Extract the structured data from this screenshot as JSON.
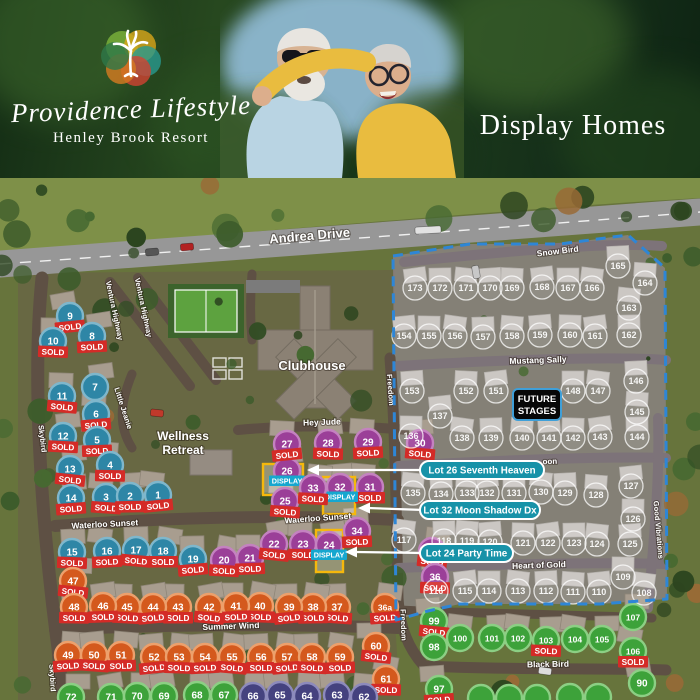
{
  "header": {
    "brand_script": "Providence Lifestyle",
    "brand_sub": "Henley Brook Resort",
    "page_title": "Display Homes"
  },
  "status_labels": {
    "sold": "SOLD",
    "display": "DISPLAY"
  },
  "future_badge": {
    "line1": "FUTURE",
    "line2": "STAGES"
  },
  "callouts": [
    {
      "label": "Lot 26 Seventh Heaven",
      "px": 420,
      "py": 283,
      "pw": 124,
      "ph": 18,
      "ax": 307,
      "ay": 292
    },
    {
      "label": "Lot 32 Moon Shadow Dx",
      "px": 420,
      "py": 323,
      "pw": 120,
      "ph": 18,
      "ax": 358,
      "ay": 330
    },
    {
      "label": "Lot 24 Party Time",
      "px": 420,
      "py": 366,
      "pw": 93,
      "ph": 18,
      "ax": 345,
      "ay": 374
    }
  ],
  "place_labels": [
    {
      "lines": [
        "Wellness",
        "Retreat"
      ],
      "x": 183,
      "y": 262,
      "size": 12
    },
    {
      "lines": [
        "Clubhouse"
      ],
      "x": 312,
      "y": 192,
      "size": 13
    }
  ],
  "street_labels": [
    {
      "text": "Andrea Drive",
      "x": 310,
      "y": 62,
      "rot": -5,
      "size": 13
    },
    {
      "text": "Ventura Highway",
      "x": 112,
      "y": 133,
      "rot": 78,
      "size": 7.5
    },
    {
      "text": "Ventura Highway",
      "x": 141,
      "y": 130,
      "rot": 78,
      "size": 7.5
    },
    {
      "text": "Skybird",
      "x": 40,
      "y": 261,
      "rot": 83,
      "size": 7.5
    },
    {
      "text": "Skybird",
      "x": 50,
      "y": 500,
      "rot": 87,
      "size": 7.5
    },
    {
      "text": "Little Jeanie",
      "x": 121,
      "y": 231,
      "rot": 72,
      "size": 7.5
    },
    {
      "text": "Hey Jude",
      "x": 322,
      "y": 247,
      "rot": -2,
      "size": 8.5
    },
    {
      "text": "Waterloo Sunset",
      "x": 105,
      "y": 349,
      "rot": -3,
      "size": 8.5
    },
    {
      "text": "Waterloo Sunset",
      "x": 318,
      "y": 343,
      "rot": -4,
      "size": 8.5
    },
    {
      "text": "Summer Wind",
      "x": 231,
      "y": 451,
      "rot": -2,
      "size": 8.5
    },
    {
      "text": "Freedom",
      "x": 388,
      "y": 212,
      "rot": 86,
      "size": 7.5
    },
    {
      "text": "Freedom",
      "x": 401,
      "y": 447,
      "rot": 88,
      "size": 7.5
    },
    {
      "text": "Snow Bird",
      "x": 558,
      "y": 76,
      "rot": -7,
      "size": 8.5
    },
    {
      "text": "Mustang Sally",
      "x": 538,
      "y": 185,
      "rot": -2,
      "size": 8.5
    },
    {
      "text": "oon",
      "x": 550,
      "y": 286,
      "rot": -2,
      "size": 8
    },
    {
      "text": "Heart of Gold",
      "x": 539,
      "y": 390,
      "rot": -2,
      "size": 8.5
    },
    {
      "text": "Black Bird",
      "x": 548,
      "y": 489,
      "rot": -1,
      "size": 8.5
    },
    {
      "text": "Good Vibrations",
      "x": 656,
      "y": 352,
      "rot": 85,
      "size": 7.5
    }
  ],
  "display_boxes": [
    {
      "lot": "26",
      "x": 263,
      "y": 286,
      "w": 40,
      "h": 31
    },
    {
      "lot": "32",
      "x": 323,
      "y": 299,
      "w": 32,
      "h": 37
    },
    {
      "lot": "24",
      "x": 316,
      "y": 352,
      "w": 27,
      "h": 42
    }
  ],
  "lots": [
    {
      "n": "9",
      "x": 70,
      "y": 138,
      "c": "teal",
      "s": "sold"
    },
    {
      "n": "10",
      "x": 53,
      "y": 163,
      "c": "teal",
      "s": "sold"
    },
    {
      "n": "8",
      "x": 92,
      "y": 158,
      "c": "teal",
      "s": "sold"
    },
    {
      "n": "11",
      "x": 62,
      "y": 218,
      "c": "teal",
      "s": "sold"
    },
    {
      "n": "7",
      "x": 95,
      "y": 209,
      "c": "teal",
      "s": ""
    },
    {
      "n": "6",
      "x": 96,
      "y": 236,
      "c": "teal",
      "s": "sold"
    },
    {
      "n": "12",
      "x": 63,
      "y": 258,
      "c": "teal",
      "s": "sold"
    },
    {
      "n": "5",
      "x": 97,
      "y": 262,
      "c": "teal",
      "s": "sold"
    },
    {
      "n": "13",
      "x": 70,
      "y": 291,
      "c": "teal",
      "s": "sold"
    },
    {
      "n": "4",
      "x": 110,
      "y": 287,
      "c": "teal",
      "s": "sold"
    },
    {
      "n": "14",
      "x": 71,
      "y": 320,
      "c": "teal",
      "s": "sold"
    },
    {
      "n": "3",
      "x": 106,
      "y": 319,
      "c": "teal",
      "s": "sold"
    },
    {
      "n": "2",
      "x": 130,
      "y": 318,
      "c": "teal",
      "s": "sold"
    },
    {
      "n": "1",
      "x": 158,
      "y": 317,
      "c": "teal",
      "s": "sold"
    },
    {
      "n": "15",
      "x": 72,
      "y": 374,
      "c": "teal",
      "s": "sold"
    },
    {
      "n": "16",
      "x": 107,
      "y": 373,
      "c": "teal",
      "s": "sold"
    },
    {
      "n": "17",
      "x": 136,
      "y": 372,
      "c": "teal",
      "s": "sold"
    },
    {
      "n": "18",
      "x": 163,
      "y": 373,
      "c": "teal",
      "s": "sold"
    },
    {
      "n": "19",
      "x": 193,
      "y": 381,
      "c": "teal",
      "s": "sold"
    },
    {
      "n": "20",
      "x": 224,
      "y": 382,
      "c": "purple",
      "s": "sold"
    },
    {
      "n": "21",
      "x": 250,
      "y": 380,
      "c": "purple",
      "s": "sold"
    },
    {
      "n": "22",
      "x": 274,
      "y": 366,
      "c": "purple",
      "s": "sold"
    },
    {
      "n": "23",
      "x": 303,
      "y": 366,
      "c": "purple",
      "s": "sold"
    },
    {
      "n": "24",
      "x": 329,
      "y": 367,
      "c": "purple",
      "s": "display"
    },
    {
      "n": "25",
      "x": 285,
      "y": 323,
      "c": "purple",
      "s": "sold"
    },
    {
      "n": "26",
      "x": 287,
      "y": 293,
      "c": "purple",
      "s": "display"
    },
    {
      "n": "27",
      "x": 287,
      "y": 266,
      "c": "purple",
      "s": "sold"
    },
    {
      "n": "28",
      "x": 328,
      "y": 265,
      "c": "purple",
      "s": "sold"
    },
    {
      "n": "29",
      "x": 368,
      "y": 264,
      "c": "purple",
      "s": "sold"
    },
    {
      "n": "30",
      "x": 420,
      "y": 265,
      "c": "purple",
      "s": "sold"
    },
    {
      "n": "31",
      "x": 370,
      "y": 309,
      "c": "purple",
      "s": "sold"
    },
    {
      "n": "32",
      "x": 340,
      "y": 309,
      "c": "purple",
      "s": "display"
    },
    {
      "n": "33",
      "x": 313,
      "y": 310,
      "c": "purple",
      "s": "sold"
    },
    {
      "n": "34",
      "x": 357,
      "y": 353,
      "c": "purple",
      "s": "sold"
    },
    {
      "n": "35",
      "x": 432,
      "y": 373,
      "c": "purple",
      "s": "sold"
    },
    {
      "n": "36",
      "x": 435,
      "y": 399,
      "c": "purple",
      "s": "sold"
    },
    {
      "n": "36a",
      "x": 385,
      "y": 429,
      "c": "orange",
      "s": "sold"
    },
    {
      "n": "37",
      "x": 337,
      "y": 429,
      "c": "orange",
      "s": "sold"
    },
    {
      "n": "38",
      "x": 313,
      "y": 429,
      "c": "orange",
      "s": "sold"
    },
    {
      "n": "39",
      "x": 289,
      "y": 429,
      "c": "orange",
      "s": "sold"
    },
    {
      "n": "40",
      "x": 260,
      "y": 428,
      "c": "orange",
      "s": "sold"
    },
    {
      "n": "41",
      "x": 236,
      "y": 428,
      "c": "orange",
      "s": "sold"
    },
    {
      "n": "42",
      "x": 209,
      "y": 429,
      "c": "orange",
      "s": "sold"
    },
    {
      "n": "43",
      "x": 178,
      "y": 429,
      "c": "orange",
      "s": "sold"
    },
    {
      "n": "44",
      "x": 153,
      "y": 429,
      "c": "orange",
      "s": "sold"
    },
    {
      "n": "45",
      "x": 127,
      "y": 429,
      "c": "orange",
      "s": "sold"
    },
    {
      "n": "46",
      "x": 103,
      "y": 428,
      "c": "orange",
      "s": "sold"
    },
    {
      "n": "47",
      "x": 73,
      "y": 403,
      "c": "orange",
      "s": "sold"
    },
    {
      "n": "48",
      "x": 74,
      "y": 429,
      "c": "orange",
      "s": "sold"
    },
    {
      "n": "49",
      "x": 68,
      "y": 477,
      "c": "orange",
      "s": "sold"
    },
    {
      "n": "50",
      "x": 94,
      "y": 477,
      "c": "orange",
      "s": "sold"
    },
    {
      "n": "51",
      "x": 121,
      "y": 477,
      "c": "orange",
      "s": "sold"
    },
    {
      "n": "52",
      "x": 154,
      "y": 479,
      "c": "orange",
      "s": "sold"
    },
    {
      "n": "53",
      "x": 179,
      "y": 479,
      "c": "orange",
      "s": "sold"
    },
    {
      "n": "54",
      "x": 205,
      "y": 479,
      "c": "orange",
      "s": "sold"
    },
    {
      "n": "55",
      "x": 232,
      "y": 479,
      "c": "orange",
      "s": "sold"
    },
    {
      "n": "56",
      "x": 261,
      "y": 479,
      "c": "orange",
      "s": "sold"
    },
    {
      "n": "57",
      "x": 287,
      "y": 479,
      "c": "orange",
      "s": "sold"
    },
    {
      "n": "58",
      "x": 312,
      "y": 479,
      "c": "orange",
      "s": "sold"
    },
    {
      "n": "59",
      "x": 340,
      "y": 479,
      "c": "orange",
      "s": "sold"
    },
    {
      "n": "60",
      "x": 376,
      "y": 468,
      "c": "orange",
      "s": "sold"
    },
    {
      "n": "61",
      "x": 386,
      "y": 501,
      "c": "orange",
      "s": "sold"
    },
    {
      "n": "72",
      "x": 71,
      "y": 519,
      "c": "green",
      "s": ""
    },
    {
      "n": "71",
      "x": 111,
      "y": 519,
      "c": "green",
      "s": ""
    },
    {
      "n": "70",
      "x": 137,
      "y": 518,
      "c": "green",
      "s": ""
    },
    {
      "n": "69",
      "x": 164,
      "y": 518,
      "c": "green",
      "s": ""
    },
    {
      "n": "68",
      "x": 197,
      "y": 517,
      "c": "green",
      "s": ""
    },
    {
      "n": "67",
      "x": 224,
      "y": 517,
      "c": "green",
      "s": ""
    },
    {
      "n": "66",
      "x": 253,
      "y": 518,
      "c": "navy",
      "s": ""
    },
    {
      "n": "65",
      "x": 280,
      "y": 517,
      "c": "navy",
      "s": ""
    },
    {
      "n": "64",
      "x": 307,
      "y": 518,
      "c": "navy",
      "s": ""
    },
    {
      "n": "63",
      "x": 337,
      "y": 517,
      "c": "navy",
      "s": ""
    },
    {
      "n": "62",
      "x": 364,
      "y": 519,
      "c": "navy",
      "s": ""
    },
    {
      "n": "99",
      "x": 434,
      "y": 443,
      "c": "green",
      "s": "sold"
    },
    {
      "n": "98",
      "x": 434,
      "y": 469,
      "c": "green",
      "s": ""
    },
    {
      "n": "97",
      "x": 439,
      "y": 511,
      "c": "green",
      "s": "sold"
    },
    {
      "n": "100",
      "x": 460,
      "y": 460,
      "c": "green",
      "s": ""
    },
    {
      "n": "101",
      "x": 492,
      "y": 460,
      "c": "green",
      "s": ""
    },
    {
      "n": "102",
      "x": 518,
      "y": 460,
      "c": "green",
      "s": ""
    },
    {
      "n": "103",
      "x": 546,
      "y": 462,
      "c": "green",
      "s": "sold"
    },
    {
      "n": "104",
      "x": 575,
      "y": 461,
      "c": "green",
      "s": ""
    },
    {
      "n": "105",
      "x": 602,
      "y": 461,
      "c": "green",
      "s": ""
    },
    {
      "n": "106",
      "x": 633,
      "y": 473,
      "c": "green",
      "s": "sold"
    },
    {
      "n": "107",
      "x": 633,
      "y": 439,
      "c": "green",
      "s": ""
    },
    {
      "n": "90",
      "x": 642,
      "y": 505,
      "c": "green",
      "s": ""
    },
    {
      "n": "",
      "x": 481,
      "y": 520,
      "c": "green",
      "s": ""
    },
    {
      "n": "",
      "x": 509,
      "y": 520,
      "c": "green",
      "s": ""
    },
    {
      "n": "",
      "x": 537,
      "y": 520,
      "c": "green",
      "s": ""
    },
    {
      "n": "",
      "x": 570,
      "y": 519,
      "c": "green",
      "s": ""
    },
    {
      "n": "",
      "x": 598,
      "y": 519,
      "c": "green",
      "s": ""
    }
  ],
  "future_lots": [
    {
      "n": "173",
      "x": 415,
      "y": 110
    },
    {
      "n": "172",
      "x": 440,
      "y": 110
    },
    {
      "n": "171",
      "x": 466,
      "y": 110
    },
    {
      "n": "170",
      "x": 490,
      "y": 110
    },
    {
      "n": "169",
      "x": 512,
      "y": 110
    },
    {
      "n": "168",
      "x": 542,
      "y": 109
    },
    {
      "n": "167",
      "x": 568,
      "y": 110
    },
    {
      "n": "166",
      "x": 592,
      "y": 110
    },
    {
      "n": "165",
      "x": 618,
      "y": 88
    },
    {
      "n": "164",
      "x": 645,
      "y": 105
    },
    {
      "n": "154",
      "x": 404,
      "y": 158
    },
    {
      "n": "155",
      "x": 429,
      "y": 158
    },
    {
      "n": "156",
      "x": 455,
      "y": 158
    },
    {
      "n": "157",
      "x": 483,
      "y": 159
    },
    {
      "n": "158",
      "x": 512,
      "y": 158
    },
    {
      "n": "159",
      "x": 540,
      "y": 157
    },
    {
      "n": "160",
      "x": 570,
      "y": 157
    },
    {
      "n": "161",
      "x": 595,
      "y": 158
    },
    {
      "n": "162",
      "x": 629,
      "y": 157
    },
    {
      "n": "163",
      "x": 629,
      "y": 130
    },
    {
      "n": "153",
      "x": 412,
      "y": 213
    },
    {
      "n": "152",
      "x": 466,
      "y": 213
    },
    {
      "n": "151",
      "x": 496,
      "y": 213
    },
    {
      "n": "148",
      "x": 573,
      "y": 213
    },
    {
      "n": "147",
      "x": 598,
      "y": 213
    },
    {
      "n": "146",
      "x": 636,
      "y": 203
    },
    {
      "n": "145",
      "x": 637,
      "y": 234
    },
    {
      "n": "137",
      "x": 440,
      "y": 238
    },
    {
      "n": "136",
      "x": 411,
      "y": 258
    },
    {
      "n": "138",
      "x": 462,
      "y": 260
    },
    {
      "n": "139",
      "x": 491,
      "y": 260
    },
    {
      "n": "140",
      "x": 522,
      "y": 260
    },
    {
      "n": "141",
      "x": 549,
      "y": 260
    },
    {
      "n": "142",
      "x": 573,
      "y": 260
    },
    {
      "n": "143",
      "x": 600,
      "y": 259
    },
    {
      "n": "144",
      "x": 637,
      "y": 259
    },
    {
      "n": "135",
      "x": 413,
      "y": 315
    },
    {
      "n": "134",
      "x": 441,
      "y": 316
    },
    {
      "n": "133",
      "x": 467,
      "y": 315
    },
    {
      "n": "132",
      "x": 487,
      "y": 315
    },
    {
      "n": "131",
      "x": 514,
      "y": 315
    },
    {
      "n": "130",
      "x": 541,
      "y": 314
    },
    {
      "n": "129",
      "x": 565,
      "y": 315
    },
    {
      "n": "128",
      "x": 596,
      "y": 317
    },
    {
      "n": "127",
      "x": 631,
      "y": 308
    },
    {
      "n": "126",
      "x": 633,
      "y": 341
    },
    {
      "n": "117",
      "x": 404,
      "y": 362
    },
    {
      "n": "118",
      "x": 444,
      "y": 363
    },
    {
      "n": "119",
      "x": 467,
      "y": 363
    },
    {
      "n": "120",
      "x": 490,
      "y": 364
    },
    {
      "n": "121",
      "x": 523,
      "y": 365
    },
    {
      "n": "122",
      "x": 548,
      "y": 365
    },
    {
      "n": "123",
      "x": 574,
      "y": 365
    },
    {
      "n": "124",
      "x": 597,
      "y": 366
    },
    {
      "n": "125",
      "x": 630,
      "y": 366
    },
    {
      "n": "116",
      "x": 436,
      "y": 413
    },
    {
      "n": "115",
      "x": 465,
      "y": 413
    },
    {
      "n": "114",
      "x": 489,
      "y": 413
    },
    {
      "n": "113",
      "x": 518,
      "y": 413
    },
    {
      "n": "112",
      "x": 546,
      "y": 413
    },
    {
      "n": "111",
      "x": 573,
      "y": 414
    },
    {
      "n": "110",
      "x": 599,
      "y": 414
    },
    {
      "n": "109",
      "x": 623,
      "y": 399
    },
    {
      "n": "108",
      "x": 644,
      "y": 415
    }
  ],
  "colors": {
    "teal": "#2e86a6",
    "teal_rim": "#7fb7cc",
    "purple": "#9b3f98",
    "purple_rim": "#c482c0",
    "orange": "#d4591d",
    "orange_rim": "#eda06c",
    "green": "#3da23a",
    "green_rim": "#8ccf84",
    "navy": "#45427f",
    "navy_rim": "#8d8abc",
    "sold_bg": "#d42b27",
    "display_bg": "#16a7cf",
    "callout_bg": "#1792a8",
    "boundary": "#2e86d6",
    "display_outline": "#f5b80c",
    "badge_border": "#3f9fd8"
  }
}
